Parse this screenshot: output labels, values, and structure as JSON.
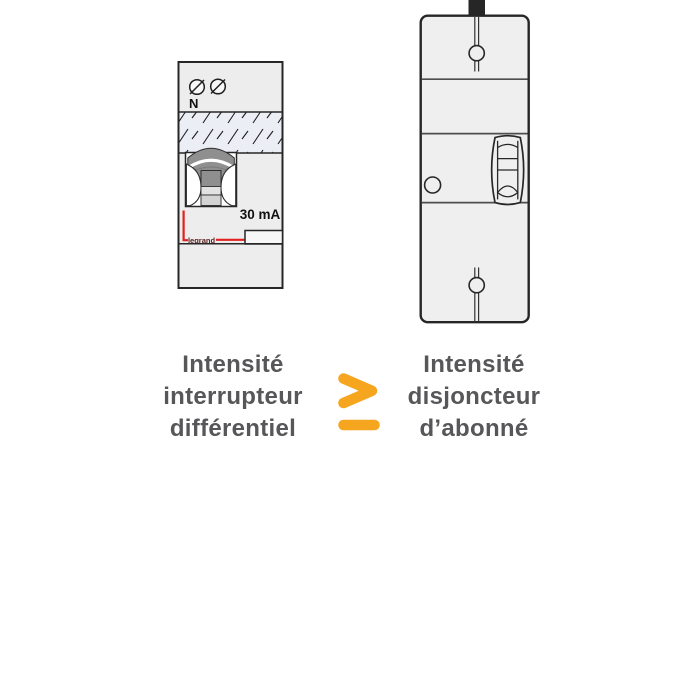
{
  "left_device": {
    "neutral_label": "N",
    "sensitivity_label": "30 mA",
    "brand_label": "legrand"
  },
  "comparison": {
    "operator": "≥",
    "operator_color": "#F6A51E"
  },
  "captions": {
    "left": {
      "lines": [
        "Intensité",
        "interrupteur",
        "différentiel"
      ]
    },
    "right": {
      "lines": [
        "Intensité",
        "disjoncteur",
        "d’abonné"
      ]
    }
  },
  "icons": {
    "left_device": [
      "screw-terminal-icon",
      "toggle-lever-icon",
      "test-button-icon"
    ],
    "right_device": [
      "screw-slot-icon",
      "rocker-switch-icon",
      "round-button-icon"
    ],
    "operator": "greater-equal-icon"
  },
  "colors": {
    "caption_text": "#57575A",
    "accent_orange": "#F6A51E",
    "wire_red": "#E3201F",
    "device_fill": "#EFEFEF",
    "device_outline": "#272727",
    "hatch_panel_fill": "#ECEEF6",
    "toggle_gray": "#8F8F8F",
    "brand_text": "#5C2020",
    "cable_black": "#262626"
  }
}
